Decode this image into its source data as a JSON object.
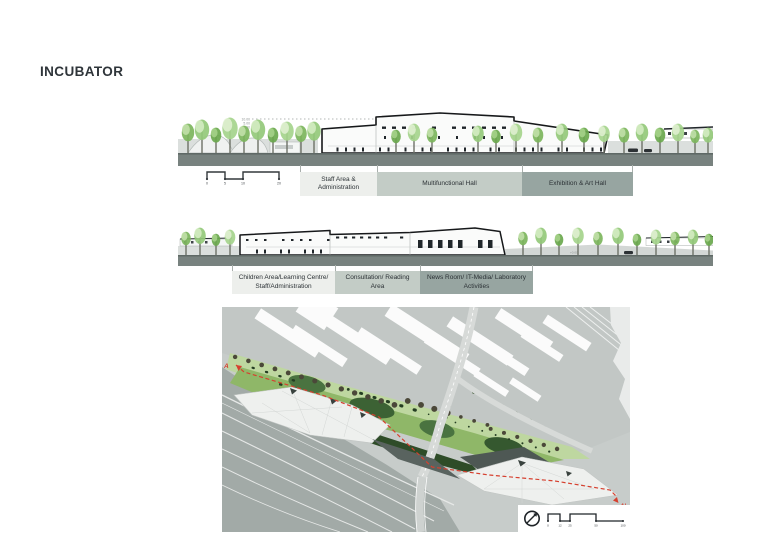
{
  "page": {
    "title": "INCUBATOR"
  },
  "elevation_top": {
    "name": "Section A-A elevation 1",
    "levels": [
      "10.00",
      "5.00",
      "0.00"
    ],
    "scale": {
      "ticks": [
        "0",
        "5",
        "10",
        "20"
      ]
    },
    "zones": [
      {
        "label": "Staff Area & Administration",
        "color": "#edefec"
      },
      {
        "label": "Multifunctional Hall",
        "color": "#c3ccc6"
      },
      {
        "label": "Exhibition & Art Hall",
        "color": "#97a5a1"
      }
    ]
  },
  "elevation_bottom": {
    "name": "Section A-A elevation 2",
    "level_note": "+0.00",
    "zones": [
      {
        "label": "Children Area/Learning Centre/ Staff/Administration",
        "color": "#edefec"
      },
      {
        "label": "Consultation/ Reading Area",
        "color": "#c3ccc6"
      },
      {
        "label": "News Room/ IT-Media/ Laboratory Activities",
        "color": "#97a5a1"
      }
    ]
  },
  "site_plan": {
    "section_start_label": "A",
    "section_end_label": "A'",
    "scale": {
      "ticks": [
        "0",
        "12",
        "25",
        "50",
        "100"
      ]
    },
    "colors": {
      "section_line": "#d6402f",
      "ground": "#c7ccca",
      "roads": "#a2aaa7",
      "green_light": "#bed7a0",
      "green_mid": "#8fb768",
      "green_dark": "#3c6234",
      "roof_white": "#eef0ee",
      "wedge_dark": "#59635f"
    }
  },
  "colors": {
    "ground_band": "#78827f",
    "building_outline": "#16181a",
    "zone_fills": [
      "#edefec",
      "#c3ccc6",
      "#97a5a1"
    ]
  }
}
